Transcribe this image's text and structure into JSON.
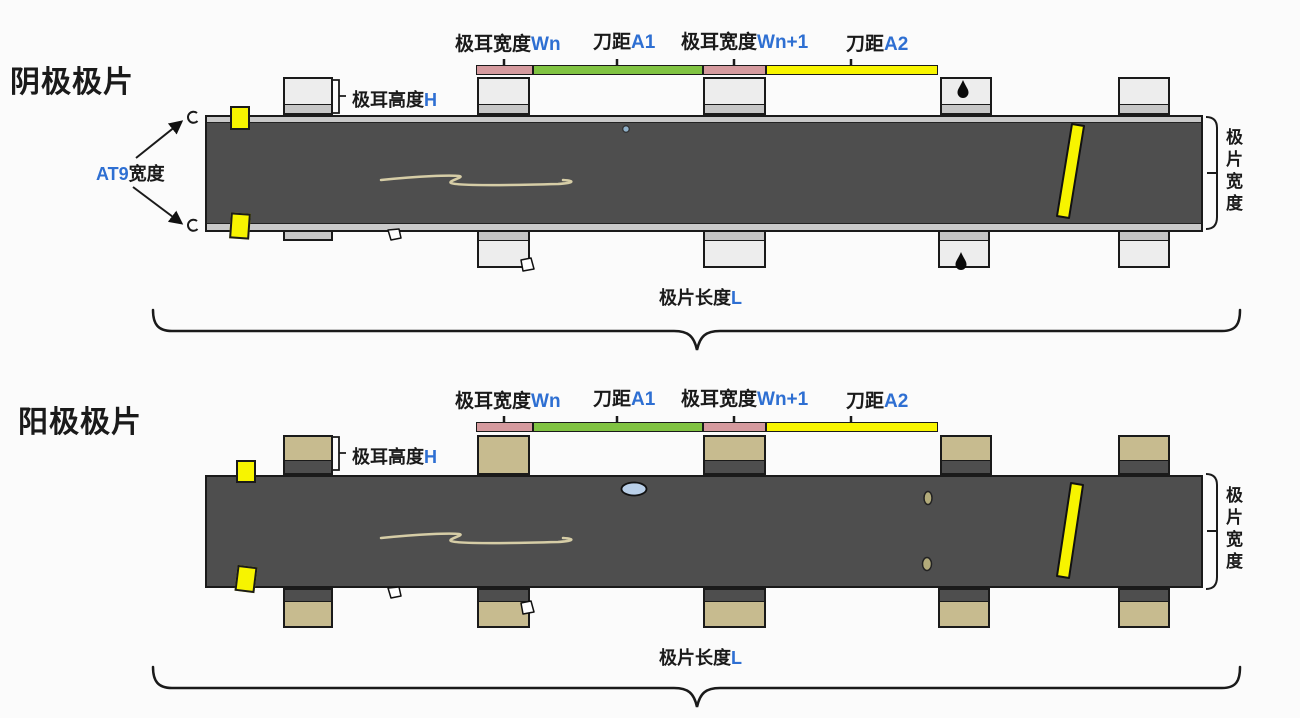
{
  "colors": {
    "background": "#fbfbfb",
    "strip_dark": "#4e4e4e",
    "strip_edge_light": "#c9c9c9",
    "cathode_tab_body": "#ededed",
    "cathode_tab_band": "#c6c6c6",
    "anode_tab_body": "#c7bb8f",
    "anode_tab_band": "#4e4e4e",
    "marker_yellow": "#f7f400",
    "bar_pink": "#d59a9e",
    "bar_green": "#80c342",
    "bar_yellow": "#f8f500",
    "variable_blue": "#2e6fd2",
    "text_black": "#1a1a1a",
    "line_black": "#1a1a1a",
    "scratch_tan": "#d6cda6",
    "ellipse_blue": "#b9cfe8",
    "oval_olive": "#b3ab7a",
    "dot_blue": "#8fb0c9"
  },
  "diagrams": [
    {
      "title": "阴极极片",
      "labels": {
        "tab_width_n": {
          "name": "极耳宽度",
          "var": "Wn"
        },
        "knife_a1": {
          "name": "刀距",
          "var": "A1"
        },
        "tab_width_n1": {
          "name": "极耳宽度",
          "var": "Wn+1"
        },
        "knife_a2": {
          "name": "刀距",
          "var": "A2"
        },
        "tab_height": {
          "name": "极耳高度",
          "var": "H"
        },
        "at9_width": {
          "var": "AT9",
          "name": "宽度"
        },
        "sheet_width": "极片宽度",
        "sheet_length": {
          "name": "极片长度",
          "var": "L"
        }
      }
    },
    {
      "title": "阳极极片",
      "labels": {
        "tab_width_n": {
          "name": "极耳宽度",
          "var": "Wn"
        },
        "knife_a1": {
          "name": "刀距",
          "var": "A1"
        },
        "tab_width_n1": {
          "name": "极耳宽度",
          "var": "Wn+1"
        },
        "knife_a2": {
          "name": "刀距",
          "var": "A2"
        },
        "tab_height": {
          "name": "极耳高度",
          "var": "H"
        },
        "sheet_width": "极片宽度",
        "sheet_length": {
          "name": "极片长度",
          "var": "L"
        }
      }
    }
  ]
}
